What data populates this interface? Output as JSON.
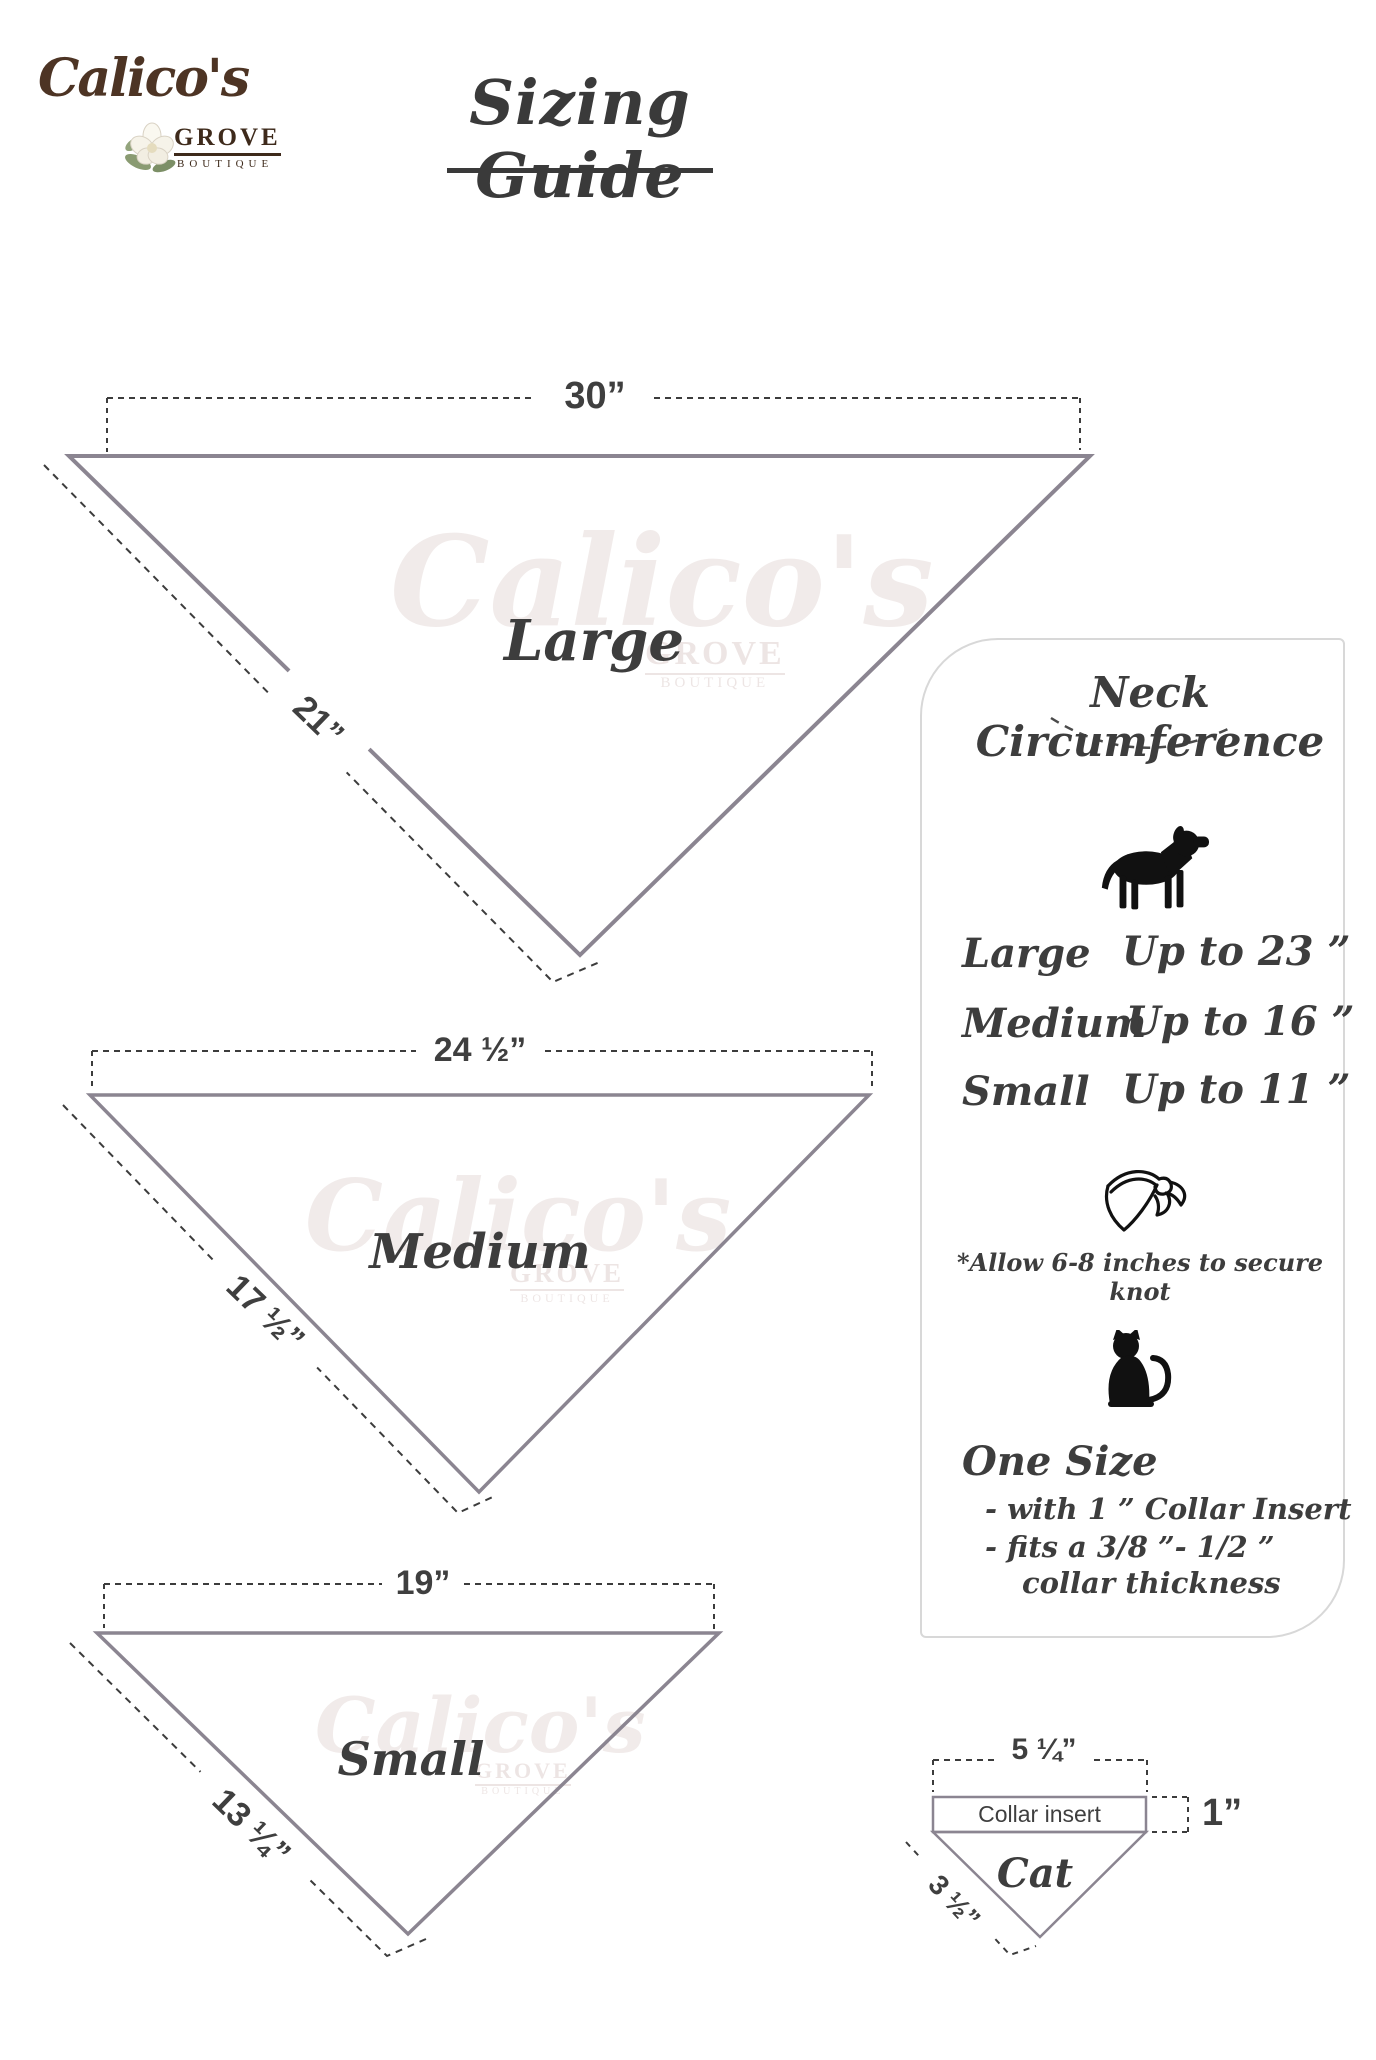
{
  "logo": {
    "name": "Calico's",
    "grove": "GROVE",
    "boutique": "BOUTIQUE",
    "flower_icon": "magnolia-flower-icon",
    "brand_color": "#4d3424"
  },
  "header": {
    "title": "Sizing Guide"
  },
  "watermark": {
    "script": "Calico's",
    "grove": "GROVE",
    "boutique": "BOUTIQUE"
  },
  "triangles": [
    {
      "id": "large",
      "label": "Large",
      "top_measure": "30”",
      "side_measure": "21”"
    },
    {
      "id": "medium",
      "label": "Medium",
      "top_measure": "24 ½”",
      "side_measure": "17 ½”"
    },
    {
      "id": "small",
      "label": "Small",
      "top_measure": "19”",
      "side_measure": "13 ¼”"
    }
  ],
  "panel": {
    "title": "Neck Circumference",
    "dog_icon": "dog-silhouette-icon",
    "rows": [
      {
        "size": "Large",
        "value": "Up to 23 ”"
      },
      {
        "size": "Medium",
        "value": "Up to 16 ”"
      },
      {
        "size": "Small",
        "value": "Up to 11 ”"
      }
    ],
    "bandana_icon": "bandana-knot-icon",
    "knot_note": "*Allow 6-8 inches to secure knot",
    "cat_icon": "cat-silhouette-icon",
    "one_size_title": "One Size",
    "one_size_points": [
      "- with 1 ” Collar Insert",
      "- fits a 3/8 ”- 1/2 ”",
      "collar thickness"
    ]
  },
  "cat_diagram": {
    "top_measure": "5 ¼”",
    "collar_label": "Collar insert",
    "height_measure": "1”",
    "side_measure": "3 ½”",
    "label": "Cat"
  },
  "colors": {
    "outline_gray": "#8b8591",
    "dash_dark": "#3c3c3c",
    "panel_border": "#d8d8d8",
    "text_dark": "#3d3d3d"
  }
}
